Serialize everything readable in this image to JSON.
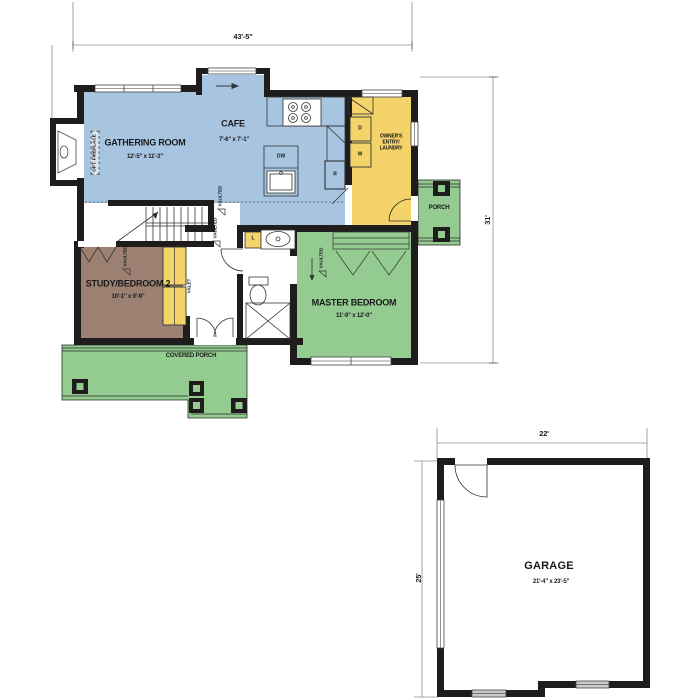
{
  "palette": {
    "wall": "#1e1d1b",
    "blue_room": "#a7c4e0",
    "yellow_room": "#f3d36a",
    "green_room": "#93cb90",
    "brown_room": "#9c8173",
    "window_gray": "#d9d9d9",
    "dim_line": "#8c8c8c"
  },
  "dims": {
    "main_width": "43'-5\"",
    "main_depth": "31'",
    "garage_width": "22'",
    "garage_depth": "25'"
  },
  "rooms": {
    "gathering_room": {
      "name": "GATHERING ROOM",
      "size": "12'-5\" x 11'-3\""
    },
    "cafe": {
      "name": "CAFE",
      "size": "7'-6\" x 7'-1\""
    },
    "owners_entry": {
      "name": "OWNER'S\nENTRY/\nLAUNDRY"
    },
    "porch": {
      "name": "PORCH"
    },
    "master_bedroom": {
      "name": "MASTER BEDROOM",
      "size": "11'-9\" x 12'-0\""
    },
    "study_bedroom2": {
      "name": "STUDY/BEDROOM 2",
      "size": "10'-1\" x 9'-9\""
    },
    "covered_porch": {
      "name": "COVERED PORCH"
    },
    "garage": {
      "name": "GARAGE",
      "size": "21'-4\" x 23'-5\""
    }
  },
  "annotations": {
    "opt_fireplace": "OPT. FIREPLACE",
    "vaulted": "VAULTED",
    "valet": "VALET"
  },
  "fixtures": {
    "dishwasher": "DW",
    "refrigerator": "R",
    "dryer": "D",
    "washer": "W",
    "lavatory": "L"
  }
}
